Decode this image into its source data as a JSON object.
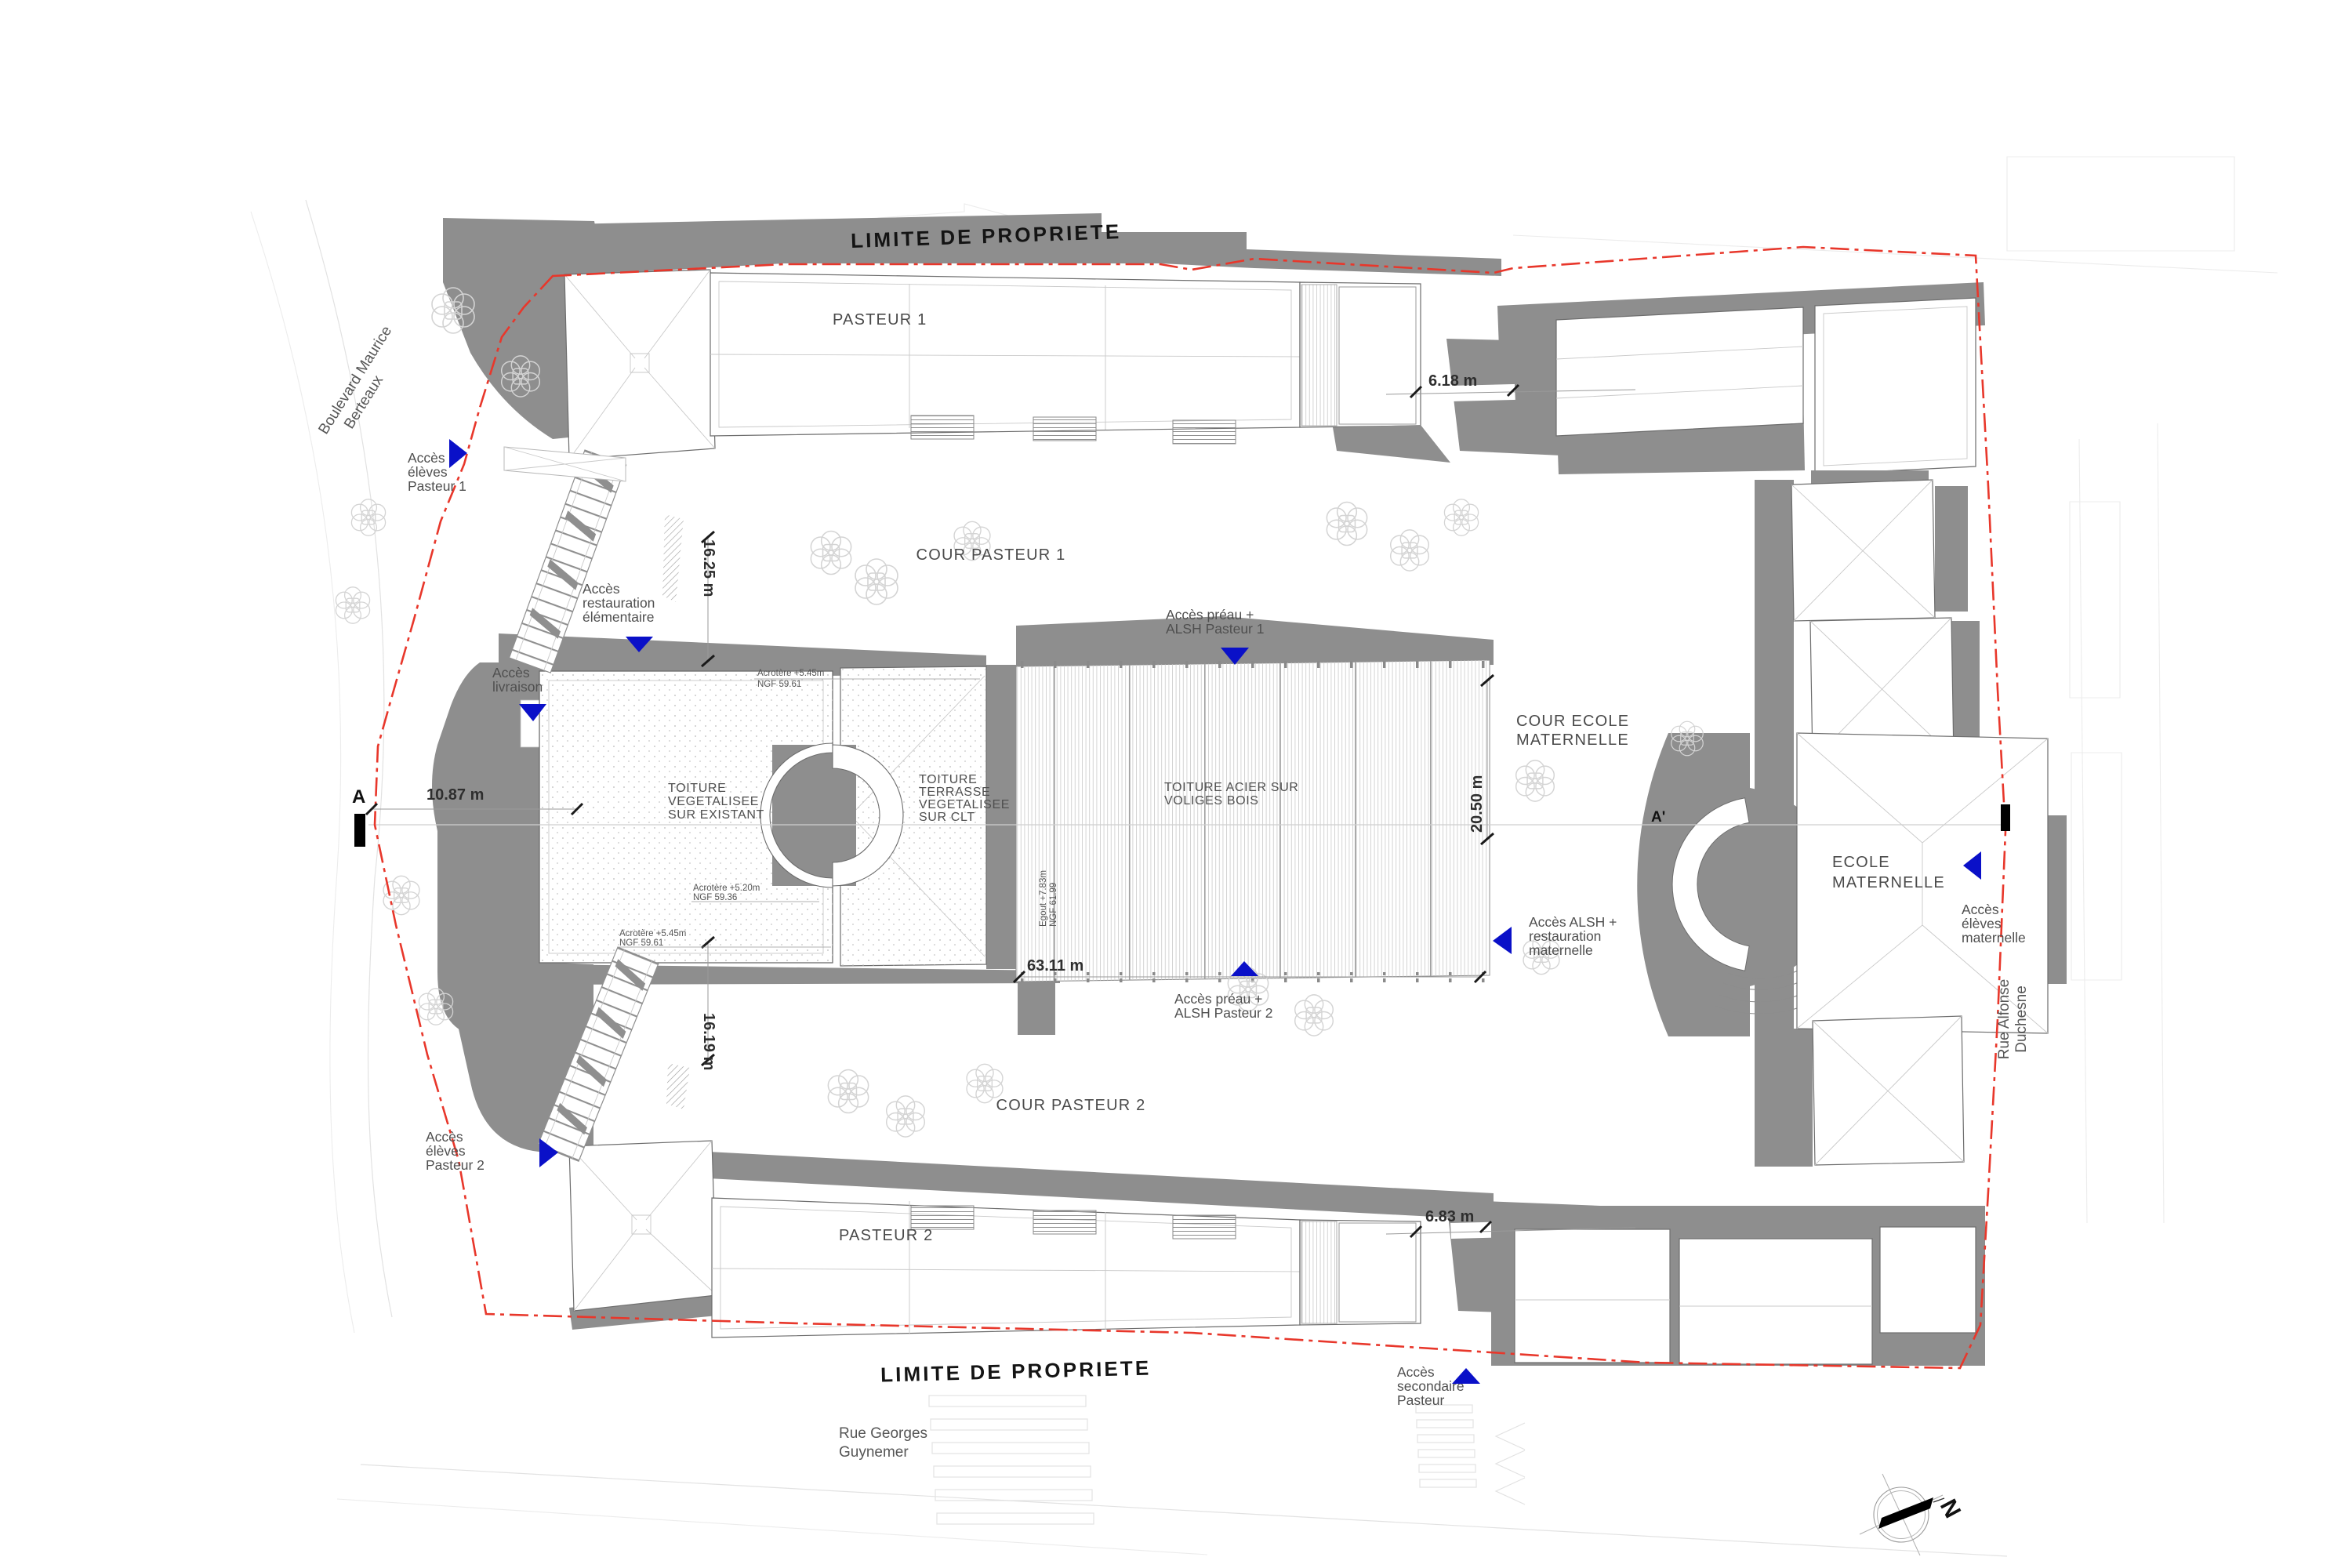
{
  "meta": {
    "drawing_type": "plan masse / plan de toiture"
  },
  "colors": {
    "building_mass": "#8e8e8e",
    "property_line_red": "#e8372b",
    "access_blue": "#0a10c8",
    "roof_line": "#6d6d6d",
    "text": "#4f4f4f"
  },
  "boundary": {
    "label_top": "LIMITE DE PROPRIETE",
    "label_bottom": "LIMITE DE PROPRIETE"
  },
  "buildings": {
    "pasteur1": "PASTEUR 1",
    "pasteur2": "PASTEUR 2",
    "ecole_maternelle": {
      "l1": "ECOLE",
      "l2": "MATERNELLE"
    }
  },
  "courtyards": {
    "cour_pasteur1": "COUR PASTEUR 1",
    "cour_pasteur2": "COUR PASTEUR 2",
    "cour_ecole": {
      "l1": "COUR ECOLE",
      "l2": "MATERNELLE"
    }
  },
  "roofs": {
    "vegetalisee": {
      "l1": "TOITURE",
      "l2": "VEGETALISEE",
      "l3": "SUR EXISTANT"
    },
    "terrasse": {
      "l1": "TOITURE",
      "l2": "TERRASSE",
      "l3": "VEGETALISEE",
      "l4": "SUR CLT"
    },
    "acier": {
      "l1": "TOITURE ACIER SUR",
      "l2": "VOLIGES BOIS"
    }
  },
  "access": {
    "eleves_p1": {
      "l1": "Accès",
      "l2": "élèves",
      "l3": "Pasteur 1"
    },
    "restauration": {
      "l1": "Accès",
      "l2": "restauration",
      "l3": "élémentaire"
    },
    "livraison": {
      "l1": "Accès",
      "l2": "livraison"
    },
    "preau_p1": {
      "l1": "Accès préau +",
      "l2": "ALSH Pasteur 1"
    },
    "preau_p2": {
      "l1": "Accès préau +",
      "l2": "ALSH Pasteur 2"
    },
    "alsh_maternelle": {
      "l1": "Accès ALSH +",
      "l2": "restauration",
      "l3": "maternelle"
    },
    "eleves_maternelle": {
      "l1": "Accès",
      "l2": "élèves",
      "l3": "maternelle"
    },
    "eleves_p2": {
      "l1": "Accès",
      "l2": "élèves",
      "l3": "Pasteur 2"
    },
    "secondaire": {
      "l1": "Accès",
      "l2": "secondaire",
      "l3": "Pasteur"
    }
  },
  "streets": {
    "boulevard": {
      "l1": "Boulevard Maurice",
      "l2": "Berteaux"
    },
    "rue_georges": {
      "l1": "Rue Georges",
      "l2": "Guynemer"
    },
    "rue_alfonse": {
      "l1": "Rue Alfonse",
      "l2": "Duchesne"
    }
  },
  "dimensions": {
    "d_16_25": "16.25 m",
    "d_16_19": "16.19 m",
    "d_10_87": "10.87 m",
    "d_20_50": "20.50 m",
    "d_63_11": "63.11 m",
    "d_6_18": "6.18 m",
    "d_6_83": "6.83 m"
  },
  "levels": {
    "acrotere_n": {
      "l1": "Acrotère +5.45m",
      "l2": "NGF 59.61"
    },
    "acrotere_mid": {
      "l1": "Acrotère +5.20m",
      "l2": "NGF 59.36"
    },
    "acrotere_s": {
      "l1": "Acrotère +5.45m",
      "l2": "NGF 59.61"
    },
    "egout": {
      "l1": "Egout +7.83m",
      "l2": "NGF 61.99"
    }
  },
  "section": {
    "a_left": "A",
    "a_right": "A'"
  },
  "north": {
    "label": "N"
  }
}
